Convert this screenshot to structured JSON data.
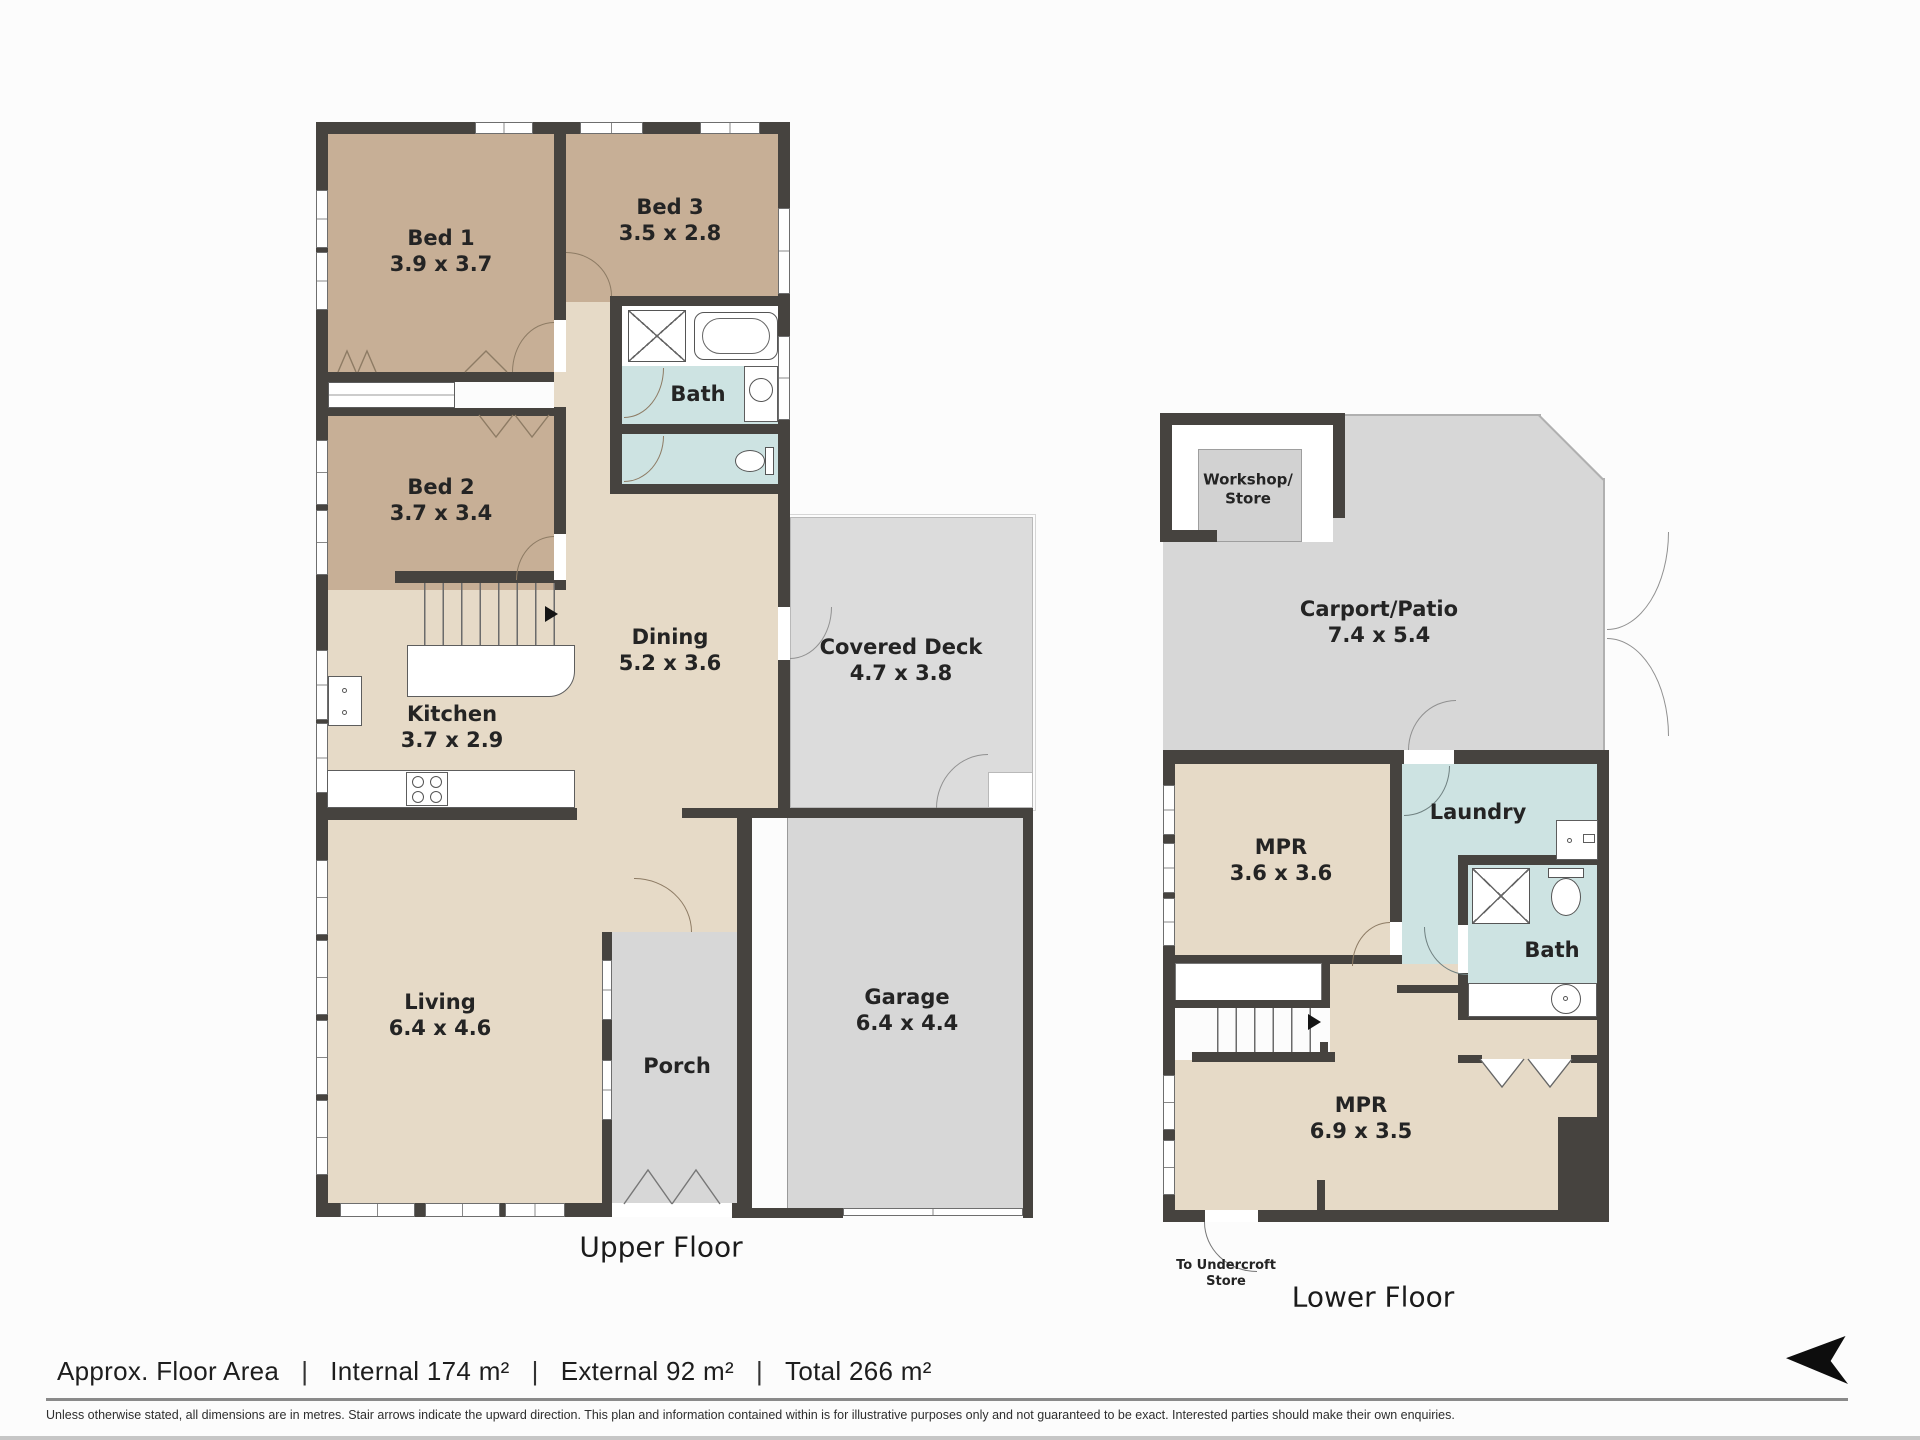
{
  "palette": {
    "wall": "#46433f",
    "tan": "#c7af96",
    "beige": "#e6dac7",
    "blue": "#cde3e2",
    "gray_deck": "#dcdcdc",
    "gray_area": "#d7d7d7",
    "workshop_floor": "#d2d2d2",
    "arc": "#8d7b64",
    "bg": "#fcfcfc"
  },
  "upper": {
    "title": "Upper Floor",
    "rooms": {
      "bed1": {
        "name": "Bed 1",
        "dims": "3.9 x 3.7"
      },
      "bed2": {
        "name": "Bed 2",
        "dims": "3.7 x 3.4"
      },
      "bed3": {
        "name": "Bed 3",
        "dims": "3.5 x 2.8"
      },
      "bath": {
        "name": "Bath"
      },
      "dining": {
        "name": "Dining",
        "dims": "5.2 x 3.6"
      },
      "kitchen": {
        "name": "Kitchen",
        "dims": "3.7 x 2.9"
      },
      "living": {
        "name": "Living",
        "dims": "6.4 x 4.6"
      },
      "covered_deck": {
        "name": "Covered Deck",
        "dims": "4.7 x 3.8"
      },
      "porch": {
        "name": "Porch"
      },
      "garage": {
        "name": "Garage",
        "dims": "6.4 x 4.4"
      }
    }
  },
  "lower": {
    "title": "Lower Floor",
    "rooms": {
      "workshop": {
        "line1": "Workshop/",
        "line2": "Store"
      },
      "carport": {
        "name": "Carport/Patio",
        "dims": "7.4 x 5.4"
      },
      "mpr1": {
        "name": "MPR",
        "dims": "3.6 x 3.6"
      },
      "laundry": {
        "name": "Laundry"
      },
      "bath": {
        "name": "Bath"
      },
      "mpr2": {
        "name": "MPR",
        "dims": "6.9 x 3.5"
      },
      "undercroft": {
        "line1": "To Undercroft",
        "line2": "Store"
      }
    }
  },
  "footer": {
    "area_label": "Approx. Floor Area",
    "separator": "|",
    "internal": "Internal 174 m²",
    "external": "External 92 m²",
    "total": "Total 266 m²",
    "disclaimer": "Unless otherwise stated, all dimensions are in metres. Stair arrows indicate the upward direction. This plan and information contained within is for illustrative purposes only and not guaranteed to be exact. Interested parties should make their own enquiries."
  }
}
